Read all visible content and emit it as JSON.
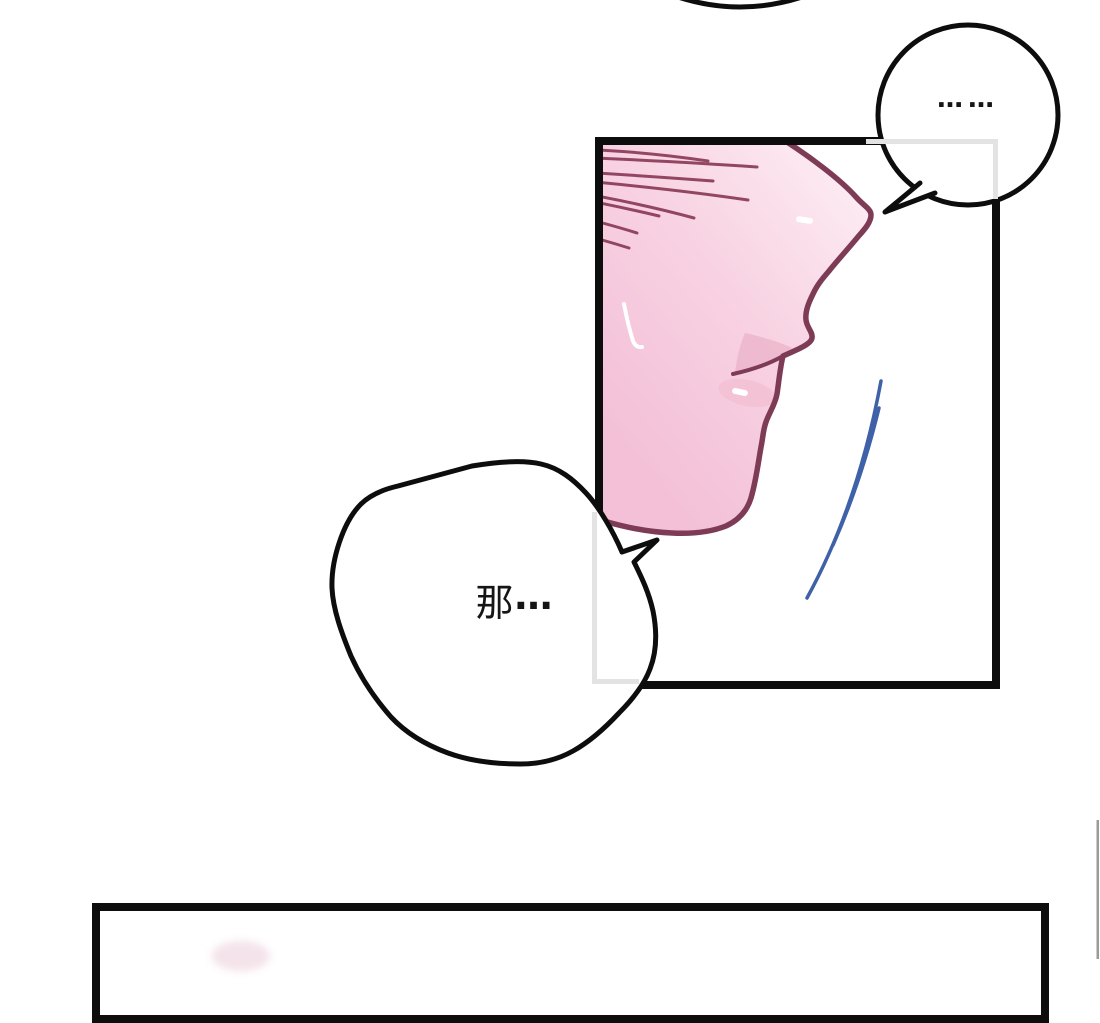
{
  "page": {
    "kind": "webtoon comic page",
    "background": "#ffffff"
  },
  "bubbles": {
    "ellipsis": {
      "text": "……"
    },
    "na": {
      "char": "那",
      "ellipsis": "…"
    }
  },
  "colors": {
    "ink": "#0d0d0d",
    "panel_border": "#0d0d0d",
    "inner_frame_gray": "#e3e3e3",
    "outline_maroon": "#7e3b56",
    "hair_stroke": "#8a3a58",
    "skin_deep": "#f3c0d8",
    "skin_mid": "#f8d2e2",
    "skin_light": "#fdedf4",
    "lip_pink": "#eab0c8",
    "blush_pink": "#f3bfd2",
    "highlight_white": "#ffffff",
    "motion_blue": "#3e61a8",
    "edge_line_gray": "#9b9b9b"
  }
}
